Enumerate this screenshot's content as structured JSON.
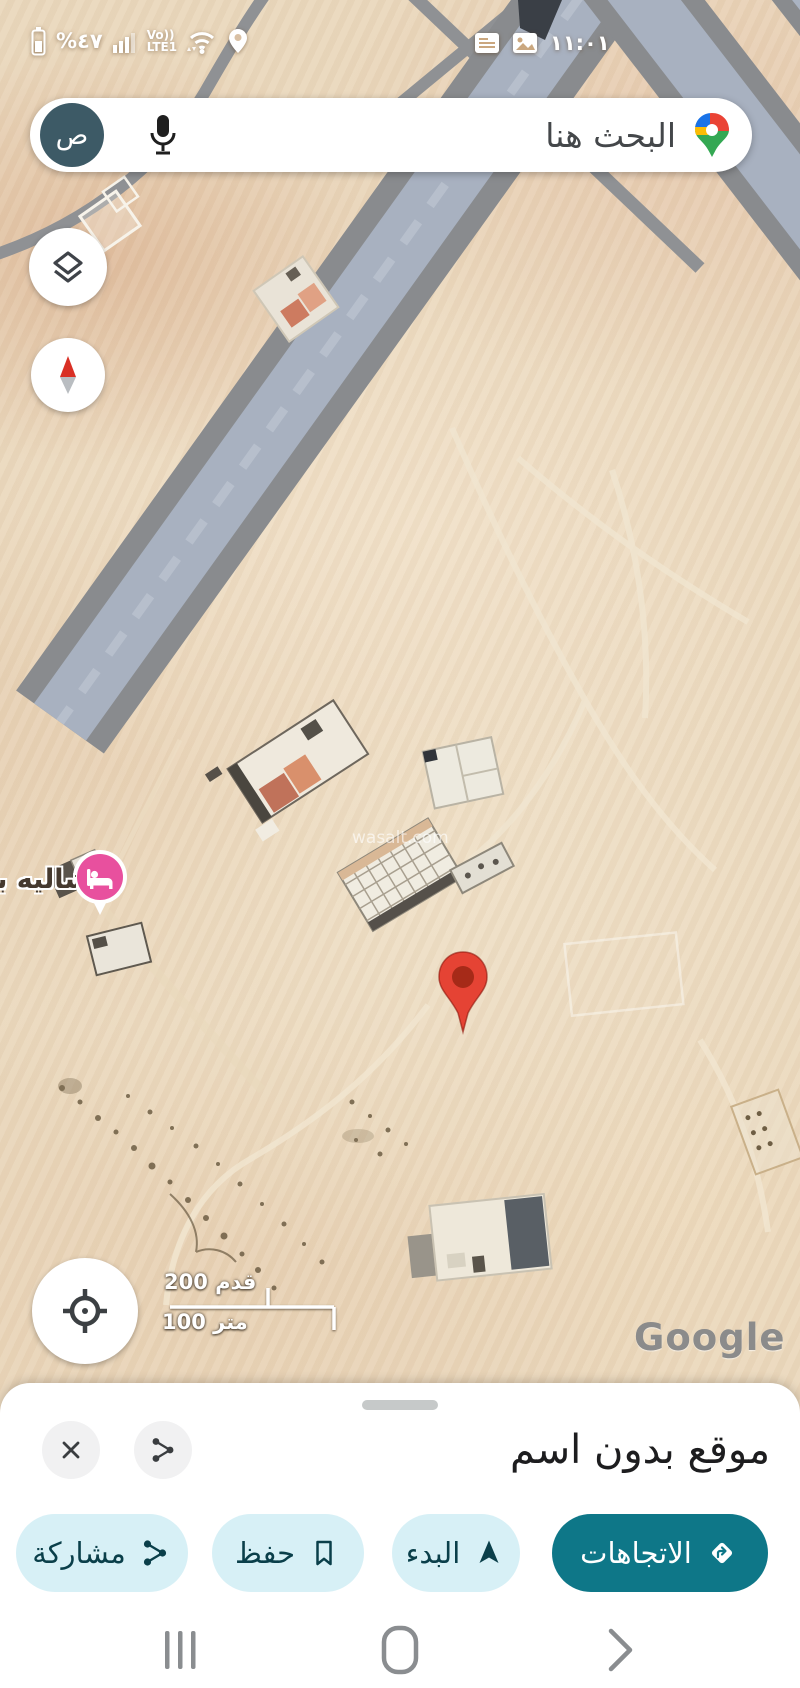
{
  "status_bar": {
    "battery_percent": "%٤٧",
    "volte_line1": "Vo))",
    "volte_line2": "LTE1",
    "time": "١١:٠١"
  },
  "search": {
    "placeholder": "البحث هنا",
    "avatar_letter": "ص"
  },
  "map": {
    "poi_label": "شاليه بـ",
    "watermark": "wasalt.com",
    "scale": {
      "feet": "200 قدم",
      "meters": "100 متر"
    },
    "attribution": "Google"
  },
  "sheet": {
    "title": "موقع بدون اسم",
    "directions_label": "الاتجاهات",
    "start_label": "البدء",
    "save_label": "حفظ",
    "share_label": "مشاركة"
  },
  "colors": {
    "accent_teal": "#0e7788",
    "light_button": "#d7f0f6",
    "pin_red": "#e54334",
    "poi_pink": "#e8509e",
    "highway_gray": "#898b8e",
    "highway_blue": "#a8b1c0",
    "sand": "#ead8bd"
  }
}
